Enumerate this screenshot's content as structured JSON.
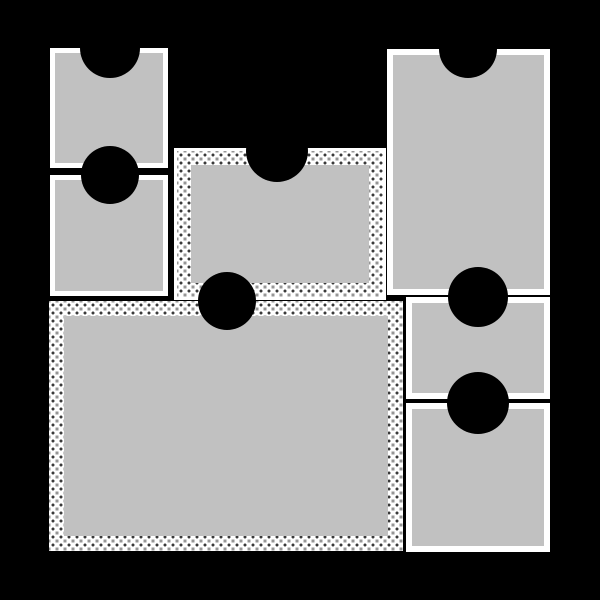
{
  "app": {
    "title": "photo-collage-template",
    "description": "Black scrapbook page with seven gray photo placeholder slots, each with a semicircular thumb-notch cutout at the top edge"
  },
  "canvas": {
    "width": 600,
    "height": 600,
    "background": "#000000"
  },
  "palette": {
    "page_background": "#000000",
    "frame_border_white": "#ffffff",
    "placeholder_gray": "#c1c1c1",
    "lace_base_gray": "#969696",
    "lace_thread_white": "#ffffff",
    "lace_stitch_dark": "#3a3a3a",
    "notch_black": "#000000"
  },
  "frames": [
    {
      "id": "top-left-square",
      "label": "photo slot 1",
      "border_style": "white",
      "x": 50,
      "y": 48,
      "w": 118,
      "h": 120,
      "inset_px": 5,
      "outline_px": 0,
      "notch": {
        "cx": 60,
        "r": 30
      }
    },
    {
      "id": "left-small",
      "label": "photo slot 2",
      "border_style": "white",
      "x": 50,
      "y": 175,
      "w": 118,
      "h": 121,
      "inset_px": 5,
      "outline_px": 0,
      "notch": {
        "cx": 60,
        "r": 29
      }
    },
    {
      "id": "center-lace",
      "label": "photo slot 3",
      "border_style": "lace-trim",
      "x": 177,
      "y": 151,
      "w": 206,
      "h": 146,
      "inset_px": 14,
      "outline_px": 3,
      "notch": {
        "cx": 100,
        "r": 31
      }
    },
    {
      "id": "right-tall",
      "label": "photo slot 4",
      "border_style": "white",
      "x": 387,
      "y": 49,
      "w": 163,
      "h": 246,
      "inset_px": 6,
      "outline_px": 0,
      "notch": {
        "cx": 81,
        "r": 29
      }
    },
    {
      "id": "bottom-large-lace",
      "label": "photo slot 5",
      "border_style": "lace-trim",
      "x": 49,
      "y": 301,
      "w": 354,
      "h": 250,
      "inset_px": 15,
      "outline_px": 0,
      "notch": {
        "cx": 178,
        "r": 29
      }
    },
    {
      "id": "right-middle",
      "label": "photo slot 6",
      "border_style": "white",
      "x": 406,
      "y": 297,
      "w": 144,
      "h": 102,
      "inset_px": 6,
      "outline_px": 0,
      "notch": {
        "cx": 72,
        "r": 30
      }
    },
    {
      "id": "right-bottom",
      "label": "photo slot 7",
      "border_style": "white",
      "x": 406,
      "y": 403,
      "w": 144,
      "h": 149,
      "inset_px": 6,
      "outline_px": 0,
      "notch": {
        "cx": 72,
        "r": 31
      }
    }
  ]
}
